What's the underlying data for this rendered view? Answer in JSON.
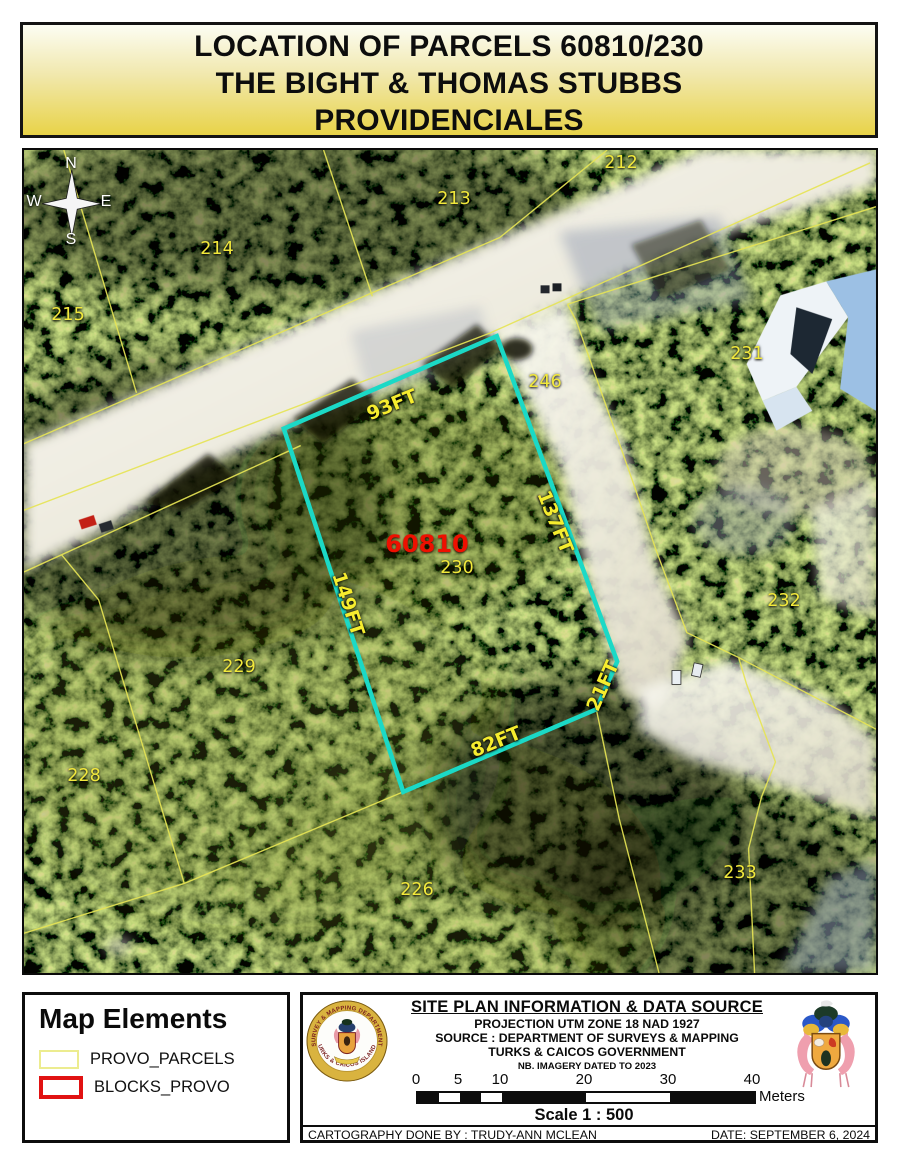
{
  "title": {
    "line1": "LOCATION OF PARCELS 60810/230",
    "line2": "THE BIGHT & THOMAS STUBBS",
    "line3": "PROVIDENCIALES"
  },
  "map": {
    "compass": {
      "north": "N",
      "east": "E",
      "south": "S",
      "west": "W"
    },
    "highlight_parcel": {
      "parcel_no": "60810",
      "block_no": "230",
      "boundary_color": "#1bd9c6",
      "edge_lengths": [
        "93FT",
        "137FT",
        "149FT",
        "82FT",
        "21FT"
      ]
    },
    "edge_labels": [
      {
        "text": "93FT"
      },
      {
        "text": "137FT"
      },
      {
        "text": "149FT"
      },
      {
        "text": "82FT"
      },
      {
        "text": "21FT"
      }
    ],
    "parcel_labels": [
      {
        "text": "212"
      },
      {
        "text": "213"
      },
      {
        "text": "214"
      },
      {
        "text": "215"
      },
      {
        "text": "231"
      },
      {
        "text": "246"
      },
      {
        "text": "232"
      },
      {
        "text": "229"
      },
      {
        "text": "228"
      },
      {
        "text": "226"
      },
      {
        "text": "233"
      }
    ],
    "colors": {
      "parcel_lines": "#e6e455",
      "highlight_boundary": "#1bd9c6",
      "label_yellow": "#f2e93c",
      "label_red": "#ee1000"
    }
  },
  "legend": {
    "title": "Map Elements",
    "items": [
      {
        "label": "PROVO_PARCELS",
        "swatch_color": "#ecec8f"
      },
      {
        "label": "BLOCKS_PROVO",
        "swatch_color": "#e11212"
      }
    ]
  },
  "info_panel": {
    "heading": "SITE PLAN INFORMATION & DATA SOURCE",
    "projection": "PROJECTION UTM ZONE 18 NAD 1927",
    "source": "SOURCE : DEPARTMENT OF SURVEYS & MAPPING",
    "government": "TURKS & CAICOS GOVERNMENT",
    "note": "NB. IMAGERY DATED TO 2023",
    "scalebar": {
      "ticks": [
        "0",
        "5",
        "10",
        "20",
        "30",
        "40"
      ],
      "unit": "Meters",
      "scale_text": "Scale 1 : 500"
    },
    "cartography": "CARTOGRAPHY DONE BY : TRUDY-ANN MCLEAN",
    "date": "DATE: SEPTEMBER 6, 2024",
    "seal": {
      "arc_top": "SURVEY & MAPPING DEPARTMENT",
      "arc_bottom": "TURKS & CAICOS ISLANDS"
    }
  }
}
